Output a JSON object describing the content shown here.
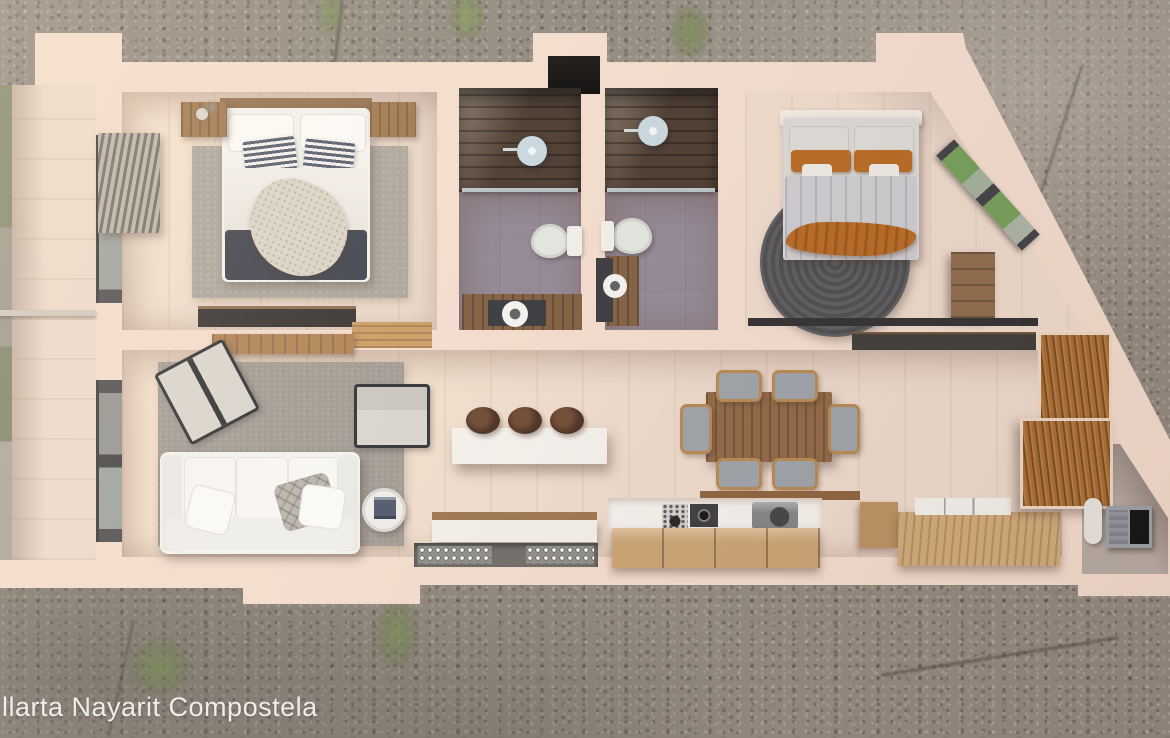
{
  "watermark": "llarta Nayarit Compostela",
  "scene": {
    "description": "Photorealistic top-down 3D dollhouse floor-plan render of a two-bedroom apartment placed on gravel ground",
    "view": "top-down"
  },
  "colors": {
    "gravel": "#8e867c",
    "wall": "#f3dccd",
    "wood-floor": "#eddacb",
    "bath-floor": "#8e8492",
    "shower-wood": "#46362b",
    "rug-gray": "#a9a39a",
    "rug-round": "#515256",
    "sofa": "#f3f2f0",
    "bed-dark": "#3b3f4a",
    "accent-orange": "#b5651d",
    "wood-oak": "#c8a171",
    "wood-rich": "#a3692f",
    "glass-green": "#6f9c55",
    "counter-white": "#f4f1ec"
  },
  "rooms": [
    {
      "name": "bedroom-1",
      "furniture": [
        "double-bed",
        "striped-pillows",
        "dark-blanket",
        "throw-blanket",
        "nightstand-left",
        "nightstand-right",
        "area-rug",
        "media-console",
        "window-blinds"
      ]
    },
    {
      "name": "bathroom-1",
      "furniture": [
        "walk-in-shower",
        "rain-shower-head",
        "glass-partition",
        "toilet",
        "vanity-round-sink"
      ]
    },
    {
      "name": "bathroom-2",
      "furniture": [
        "walk-in-shower",
        "rain-shower-head",
        "glass-partition",
        "toilet",
        "vanity-round-sink"
      ]
    },
    {
      "name": "bedroom-2",
      "furniture": [
        "double-bed",
        "orange-pillows",
        "orange-throw",
        "round-braided-rug",
        "dresser",
        "angled-corner-window",
        "closet-track"
      ]
    },
    {
      "name": "living-room",
      "furniture": [
        "white-sofa",
        "accent-chair-left",
        "accent-chair-right",
        "gray-rug",
        "round-side-table",
        "wall-console",
        "floor-window"
      ]
    },
    {
      "name": "dining-area",
      "furniture": [
        "wood-dining-table",
        "six-rattan-chairs"
      ]
    },
    {
      "name": "kitchen",
      "furniture": [
        "floating-island-bar",
        "three-stools",
        "media-console",
        "bar-glassware-unit",
        "gas-cooktop",
        "sink",
        "oak-cabinets",
        "l-shaped-counter",
        "tall-pantry-cabinets"
      ]
    },
    {
      "name": "utility-room",
      "furniture": [
        "water-heater",
        "cube-shelf"
      ]
    },
    {
      "name": "balcony",
      "furniture": [
        "glass-railing",
        "plank-floor"
      ]
    }
  ]
}
